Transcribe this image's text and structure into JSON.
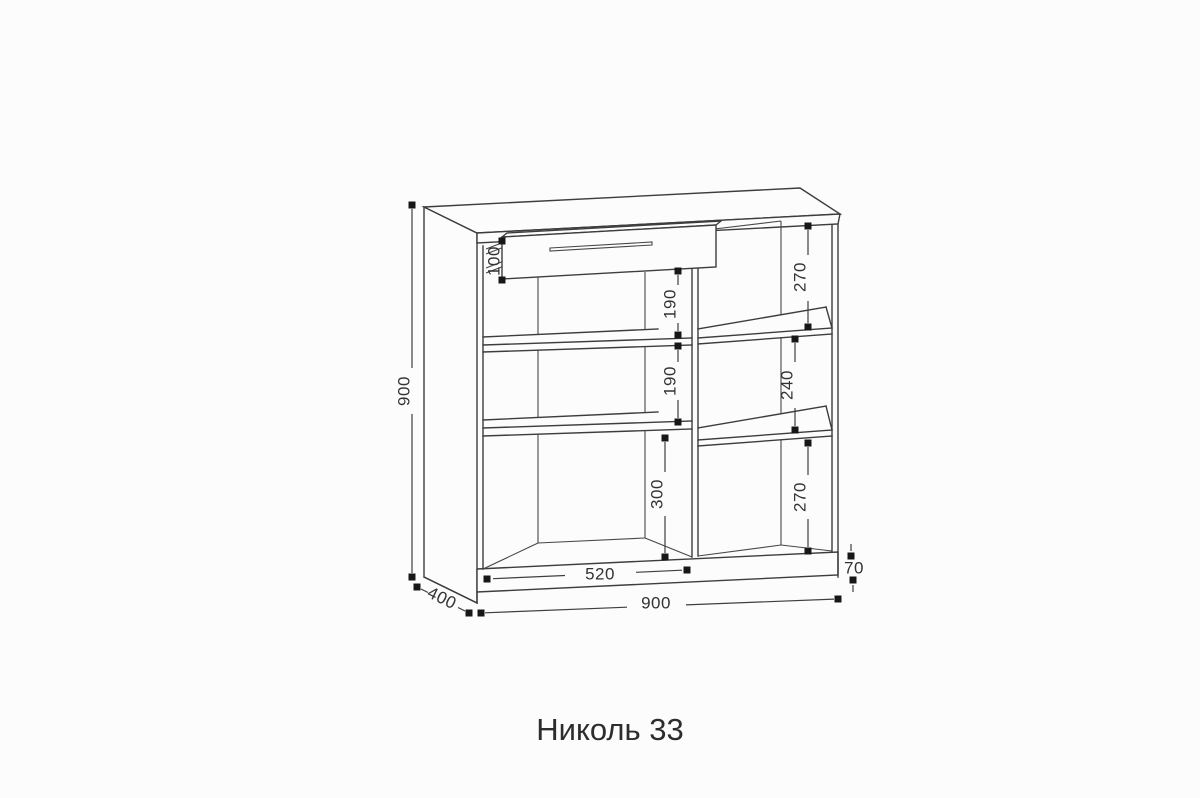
{
  "title": "Николь 33",
  "colors": {
    "background": "#fcfcfc",
    "line": "#3d3d3d",
    "text": "#333333"
  },
  "dimensions": {
    "height": "900",
    "width": "900",
    "depth": "400",
    "drawer_front_height": "100",
    "left_top_gap": "190",
    "left_middle_gap": "190",
    "left_bottom_gap": "300",
    "right_top_gap": "270",
    "right_middle_gap": "240",
    "right_bottom_gap": "270",
    "left_section_width": "520",
    "plinth_height": "70"
  }
}
